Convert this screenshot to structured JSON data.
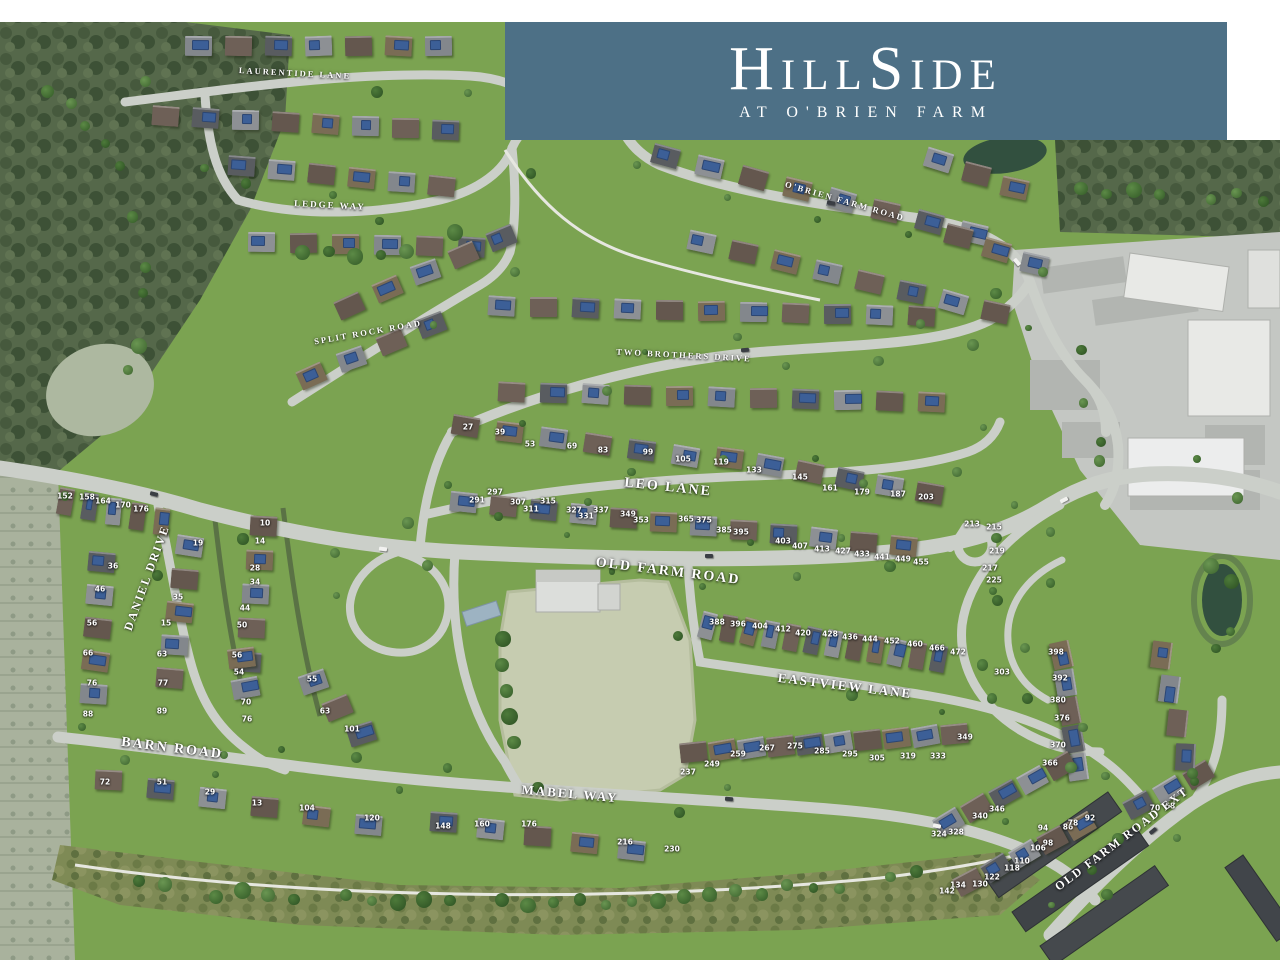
{
  "banner": {
    "title": "HillSide",
    "subtitle": "AT O'BRIEN FARM",
    "bg_color": "#4d7086",
    "text_color": "#ffffff"
  },
  "map": {
    "colors": {
      "grass": "#7ba351",
      "road": "#cbcfc9",
      "trail": "#e6e7e0",
      "woods": "#55684a",
      "field": "#c6ccb0",
      "water": "#32503f",
      "scrub": "#7e8a55",
      "photo": "#a9b29d",
      "pavement": "#c4c7c3",
      "building": "#e8e9e6",
      "townhouse_roof": "#45494d",
      "hedge": "#5a7245"
    },
    "streets": [
      {
        "label": "LAURENTIDE LANE",
        "x": 295,
        "y": 73,
        "rot": 3,
        "size": 8.5
      },
      {
        "label": "LEDGE WAY",
        "x": 330,
        "y": 205,
        "rot": 3,
        "size": 9
      },
      {
        "label": "SPLIT ROCK ROAD",
        "x": 368,
        "y": 332,
        "rot": -10,
        "size": 8.5
      },
      {
        "label": "TWO BROTHERS DRIVE",
        "x": 684,
        "y": 355,
        "rot": 3,
        "size": 8.5
      },
      {
        "label": "O'BRIEN FARM ROAD",
        "x": 845,
        "y": 201,
        "rot": 16,
        "size": 8.5
      },
      {
        "label": "LEO LANE",
        "x": 668,
        "y": 488,
        "rot": 6,
        "size": 14
      },
      {
        "label": "OLD FARM ROAD",
        "x": 668,
        "y": 572,
        "rot": 7,
        "size": 14
      },
      {
        "label": "DANIEL DRIVE",
        "x": 147,
        "y": 578,
        "rot": -70,
        "size": 12
      },
      {
        "label": "BARN ROAD",
        "x": 172,
        "y": 749,
        "rot": 7,
        "size": 14
      },
      {
        "label": "MABEL WAY",
        "x": 570,
        "y": 794,
        "rot": 5,
        "size": 13
      },
      {
        "label": "EASTVIEW LANE",
        "x": 845,
        "y": 686,
        "rot": 7,
        "size": 13
      },
      {
        "label": "OLD FARM ROAD EXT",
        "x": 1122,
        "y": 839,
        "rot": -37,
        "size": 12
      }
    ],
    "lots": [
      {
        "n": "27",
        "x": 468,
        "y": 427
      },
      {
        "n": "39",
        "x": 500,
        "y": 432
      },
      {
        "n": "53",
        "x": 530,
        "y": 444
      },
      {
        "n": "69",
        "x": 572,
        "y": 446
      },
      {
        "n": "83",
        "x": 603,
        "y": 450
      },
      {
        "n": "99",
        "x": 648,
        "y": 452
      },
      {
        "n": "105",
        "x": 683,
        "y": 459
      },
      {
        "n": "119",
        "x": 721,
        "y": 462
      },
      {
        "n": "133",
        "x": 754,
        "y": 470
      },
      {
        "n": "145",
        "x": 800,
        "y": 477
      },
      {
        "n": "161",
        "x": 830,
        "y": 488
      },
      {
        "n": "179",
        "x": 862,
        "y": 492
      },
      {
        "n": "187",
        "x": 898,
        "y": 494
      },
      {
        "n": "203",
        "x": 926,
        "y": 497
      },
      {
        "n": "291",
        "x": 477,
        "y": 500
      },
      {
        "n": "297",
        "x": 495,
        "y": 492
      },
      {
        "n": "307",
        "x": 518,
        "y": 502
      },
      {
        "n": "311",
        "x": 531,
        "y": 509
      },
      {
        "n": "315",
        "x": 548,
        "y": 501
      },
      {
        "n": "327",
        "x": 574,
        "y": 510
      },
      {
        "n": "331",
        "x": 586,
        "y": 516
      },
      {
        "n": "337",
        "x": 601,
        "y": 510
      },
      {
        "n": "349",
        "x": 628,
        "y": 514
      },
      {
        "n": "353",
        "x": 641,
        "y": 520
      },
      {
        "n": "365",
        "x": 686,
        "y": 519
      },
      {
        "n": "375",
        "x": 704,
        "y": 520
      },
      {
        "n": "385",
        "x": 724,
        "y": 530
      },
      {
        "n": "395",
        "x": 741,
        "y": 532
      },
      {
        "n": "403",
        "x": 783,
        "y": 541
      },
      {
        "n": "407",
        "x": 800,
        "y": 546
      },
      {
        "n": "413",
        "x": 822,
        "y": 549
      },
      {
        "n": "427",
        "x": 843,
        "y": 551
      },
      {
        "n": "433",
        "x": 862,
        "y": 554
      },
      {
        "n": "441",
        "x": 882,
        "y": 557
      },
      {
        "n": "449",
        "x": 903,
        "y": 559
      },
      {
        "n": "455",
        "x": 921,
        "y": 562
      },
      {
        "n": "213",
        "x": 972,
        "y": 524
      },
      {
        "n": "215",
        "x": 994,
        "y": 527
      },
      {
        "n": "219",
        "x": 997,
        "y": 551
      },
      {
        "n": "217",
        "x": 990,
        "y": 568
      },
      {
        "n": "225",
        "x": 994,
        "y": 580
      },
      {
        "n": "152",
        "x": 65,
        "y": 496
      },
      {
        "n": "158",
        "x": 87,
        "y": 497
      },
      {
        "n": "164",
        "x": 103,
        "y": 501
      },
      {
        "n": "170",
        "x": 123,
        "y": 505
      },
      {
        "n": "176",
        "x": 141,
        "y": 509
      },
      {
        "n": "36",
        "x": 113,
        "y": 566
      },
      {
        "n": "46",
        "x": 100,
        "y": 589
      },
      {
        "n": "56",
        "x": 92,
        "y": 623
      },
      {
        "n": "66",
        "x": 88,
        "y": 653
      },
      {
        "n": "76",
        "x": 92,
        "y": 683
      },
      {
        "n": "88",
        "x": 88,
        "y": 714
      },
      {
        "n": "19",
        "x": 198,
        "y": 543
      },
      {
        "n": "35",
        "x": 178,
        "y": 597
      },
      {
        "n": "15",
        "x": 166,
        "y": 623
      },
      {
        "n": "63",
        "x": 162,
        "y": 654
      },
      {
        "n": "77",
        "x": 163,
        "y": 683
      },
      {
        "n": "89",
        "x": 162,
        "y": 711
      },
      {
        "n": "10",
        "x": 265,
        "y": 523
      },
      {
        "n": "14",
        "x": 260,
        "y": 541
      },
      {
        "n": "28",
        "x": 255,
        "y": 568
      },
      {
        "n": "34",
        "x": 255,
        "y": 582
      },
      {
        "n": "44",
        "x": 245,
        "y": 608
      },
      {
        "n": "50",
        "x": 242,
        "y": 625
      },
      {
        "n": "56",
        "x": 237,
        "y": 655
      },
      {
        "n": "54",
        "x": 239,
        "y": 672
      },
      {
        "n": "55",
        "x": 312,
        "y": 679
      },
      {
        "n": "70",
        "x": 246,
        "y": 702
      },
      {
        "n": "76",
        "x": 247,
        "y": 719
      },
      {
        "n": "63",
        "x": 325,
        "y": 711
      },
      {
        "n": "101",
        "x": 352,
        "y": 729
      },
      {
        "n": "72",
        "x": 105,
        "y": 782
      },
      {
        "n": "51",
        "x": 162,
        "y": 782
      },
      {
        "n": "29",
        "x": 210,
        "y": 792
      },
      {
        "n": "13",
        "x": 257,
        "y": 803
      },
      {
        "n": "104",
        "x": 307,
        "y": 808
      },
      {
        "n": "120",
        "x": 372,
        "y": 818
      },
      {
        "n": "148",
        "x": 443,
        "y": 826
      },
      {
        "n": "160",
        "x": 482,
        "y": 824
      },
      {
        "n": "176",
        "x": 529,
        "y": 824
      },
      {
        "n": "216",
        "x": 625,
        "y": 842
      },
      {
        "n": "230",
        "x": 672,
        "y": 849
      },
      {
        "n": "388",
        "x": 717,
        "y": 622
      },
      {
        "n": "396",
        "x": 738,
        "y": 624
      },
      {
        "n": "404",
        "x": 760,
        "y": 626
      },
      {
        "n": "412",
        "x": 783,
        "y": 629
      },
      {
        "n": "420",
        "x": 803,
        "y": 633
      },
      {
        "n": "428",
        "x": 830,
        "y": 634
      },
      {
        "n": "436",
        "x": 850,
        "y": 637
      },
      {
        "n": "444",
        "x": 870,
        "y": 639
      },
      {
        "n": "452",
        "x": 892,
        "y": 641
      },
      {
        "n": "460",
        "x": 915,
        "y": 644
      },
      {
        "n": "466",
        "x": 937,
        "y": 648
      },
      {
        "n": "472",
        "x": 958,
        "y": 652
      },
      {
        "n": "303",
        "x": 1002,
        "y": 672
      },
      {
        "n": "237",
        "x": 688,
        "y": 772
      },
      {
        "n": "249",
        "x": 712,
        "y": 764
      },
      {
        "n": "259",
        "x": 738,
        "y": 754
      },
      {
        "n": "267",
        "x": 767,
        "y": 748
      },
      {
        "n": "275",
        "x": 795,
        "y": 746
      },
      {
        "n": "285",
        "x": 822,
        "y": 751
      },
      {
        "n": "295",
        "x": 850,
        "y": 754
      },
      {
        "n": "305",
        "x": 877,
        "y": 758
      },
      {
        "n": "319",
        "x": 908,
        "y": 756
      },
      {
        "n": "333",
        "x": 938,
        "y": 756
      },
      {
        "n": "349",
        "x": 965,
        "y": 737
      },
      {
        "n": "398",
        "x": 1056,
        "y": 652
      },
      {
        "n": "392",
        "x": 1060,
        "y": 678
      },
      {
        "n": "380",
        "x": 1058,
        "y": 700
      },
      {
        "n": "376",
        "x": 1062,
        "y": 718
      },
      {
        "n": "370",
        "x": 1058,
        "y": 745
      },
      {
        "n": "366",
        "x": 1050,
        "y": 763
      },
      {
        "n": "324",
        "x": 939,
        "y": 834
      },
      {
        "n": "328",
        "x": 956,
        "y": 832
      },
      {
        "n": "340",
        "x": 980,
        "y": 816
      },
      {
        "n": "346",
        "x": 997,
        "y": 809
      },
      {
        "n": "94",
        "x": 1043,
        "y": 828
      },
      {
        "n": "86",
        "x": 1068,
        "y": 827
      },
      {
        "n": "98",
        "x": 1048,
        "y": 843
      },
      {
        "n": "106",
        "x": 1038,
        "y": 848
      },
      {
        "n": "110",
        "x": 1022,
        "y": 861
      },
      {
        "n": "118",
        "x": 1012,
        "y": 868
      },
      {
        "n": "122",
        "x": 992,
        "y": 877
      },
      {
        "n": "130",
        "x": 980,
        "y": 884
      },
      {
        "n": "134",
        "x": 958,
        "y": 885
      },
      {
        "n": "142",
        "x": 947,
        "y": 891
      },
      {
        "n": "78",
        "x": 1073,
        "y": 823
      },
      {
        "n": "92",
        "x": 1090,
        "y": 818
      },
      {
        "n": "70",
        "x": 1155,
        "y": 808
      },
      {
        "n": "68",
        "x": 1170,
        "y": 806
      }
    ],
    "house_rows": [
      {
        "x": 185,
        "y": 36,
        "n": 7,
        "dx": 40,
        "dy": 0,
        "rot": 0
      },
      {
        "x": 152,
        "y": 106,
        "n": 8,
        "dx": 40,
        "dy": 2,
        "rot": 2
      },
      {
        "x": 228,
        "y": 156,
        "n": 6,
        "dx": 40,
        "dy": 4,
        "rot": 4
      },
      {
        "x": 248,
        "y": 232,
        "n": 6,
        "dx": 42,
        "dy": 1,
        "rot": 2
      },
      {
        "x": 336,
        "y": 296,
        "n": 5,
        "dx": 38,
        "dy": -17,
        "rot": -22
      },
      {
        "x": 298,
        "y": 366,
        "n": 4,
        "dx": 40,
        "dy": -17,
        "rot": -22
      },
      {
        "x": 488,
        "y": 296,
        "n": 11,
        "dx": 42,
        "dy": 1,
        "rot": 2
      },
      {
        "x": 498,
        "y": 382,
        "n": 11,
        "dx": 42,
        "dy": 1,
        "rot": 2
      },
      {
        "x": 652,
        "y": 146,
        "n": 8,
        "dx": 44,
        "dy": 11,
        "rot": 15
      },
      {
        "x": 688,
        "y": 232,
        "n": 8,
        "dx": 42,
        "dy": 10,
        "rot": 14
      },
      {
        "x": 452,
        "y": 416,
        "n": 6,
        "dx": 44,
        "dy": 6,
        "rot": 8
      },
      {
        "x": 716,
        "y": 448,
        "n": 6,
        "dx": 40,
        "dy": 7,
        "rot": 10
      },
      {
        "x": 450,
        "y": 492,
        "n": 12,
        "dx": 40,
        "dy": 4,
        "rot": 5
      },
      {
        "x": 58,
        "y": 488,
        "n": 5,
        "dx": 24,
        "dy": 5,
        "rot": 8,
        "style": "narrow"
      },
      {
        "x": 88,
        "y": 552,
        "n": 5,
        "dx": -2,
        "dy": 33,
        "rot": 6
      },
      {
        "x": 176,
        "y": 536,
        "n": 5,
        "dx": -5,
        "dy": 33,
        "rot": 6
      },
      {
        "x": 250,
        "y": 516,
        "n": 5,
        "dx": -4,
        "dy": 34,
        "rot": 4
      },
      {
        "x": 228,
        "y": 648,
        "n": 2,
        "dx": 4,
        "dy": 30,
        "rot": -8
      },
      {
        "x": 300,
        "y": 672,
        "n": 3,
        "dx": 24,
        "dy": 26,
        "rot": -20
      },
      {
        "x": 95,
        "y": 770,
        "n": 6,
        "dx": 52,
        "dy": 9,
        "rot": 4
      },
      {
        "x": 430,
        "y": 812,
        "n": 5,
        "dx": 47,
        "dy": 7,
        "rot": 5
      },
      {
        "x": 700,
        "y": 612,
        "n": 12,
        "dx": 21,
        "dy": 3,
        "rot": 12,
        "style": "narrow"
      },
      {
        "x": 680,
        "y": 742,
        "n": 10,
        "dx": 29,
        "dy": -2,
        "rot": -8
      },
      {
        "x": 1048,
        "y": 645,
        "n": 5,
        "dx": 4,
        "dy": 28,
        "rot": 80
      },
      {
        "x": 935,
        "y": 812,
        "n": 5,
        "dx": 28,
        "dy": -14,
        "rot": -30
      },
      {
        "x": 955,
        "y": 872,
        "n": 5,
        "dx": 28,
        "dy": -14,
        "rot": -30
      },
      {
        "x": 1125,
        "y": 795,
        "n": 3,
        "dx": 30,
        "dy": -15,
        "rot": -30
      },
      {
        "x": 925,
        "y": 150,
        "n": 3,
        "dx": 38,
        "dy": 14,
        "rot": 15
      },
      {
        "x": 945,
        "y": 226,
        "n": 3,
        "dx": 38,
        "dy": 14,
        "rot": 15
      },
      {
        "x": 1148,
        "y": 645,
        "n": 4,
        "dx": 8,
        "dy": 34,
        "rot": 95
      }
    ]
  }
}
